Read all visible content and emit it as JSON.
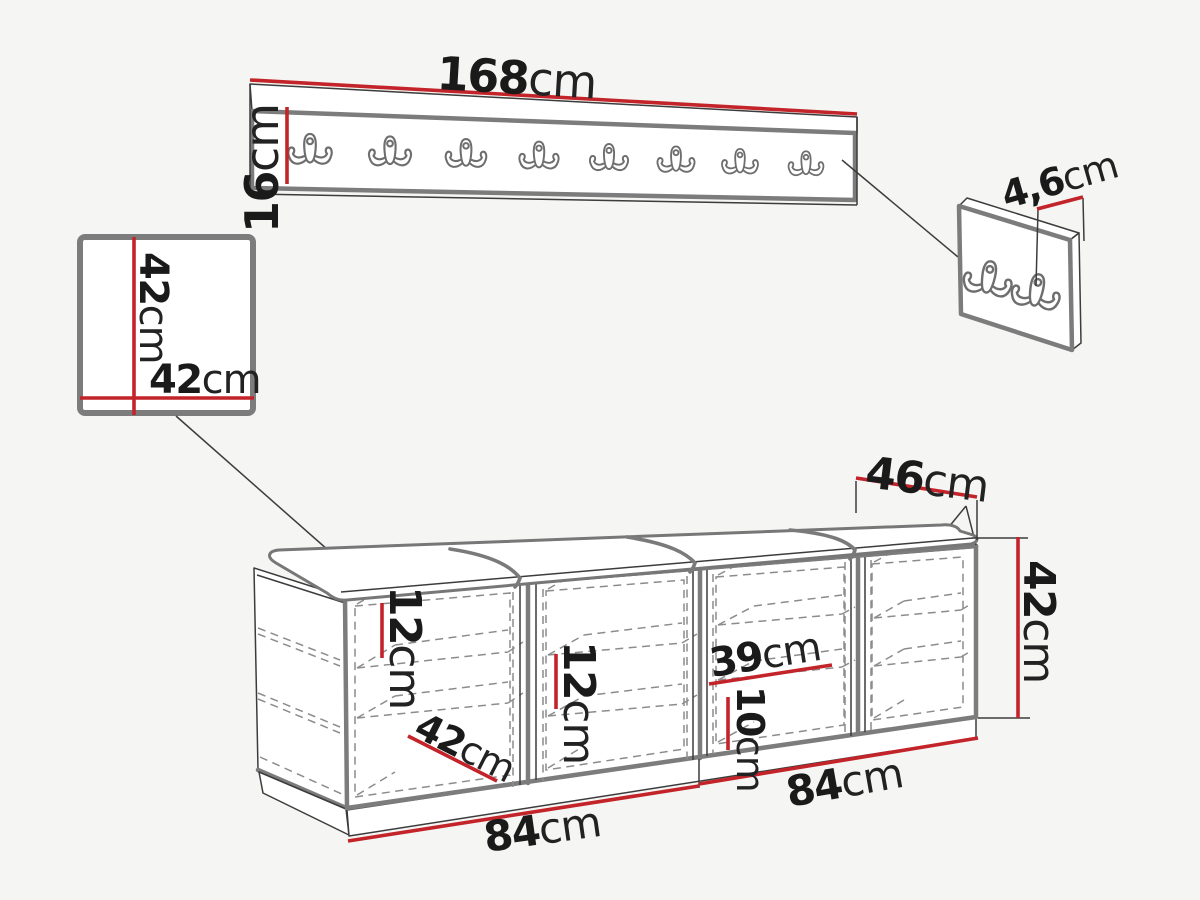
{
  "colors": {
    "background": "#f5f5f3",
    "dimension_red": "#c3242a",
    "frame_gray": "#7c7c7c",
    "line_dark": "#3c3c3c",
    "dash_gray": "#8c8c8c",
    "text_black": "#1a1a1a"
  },
  "coat_rack": {
    "hook_count": 8,
    "width": {
      "value": "168",
      "unit": "cm"
    },
    "height": {
      "value": "16",
      "unit": "cm"
    }
  },
  "hook_panel": {
    "hook_count": 2,
    "depth": {
      "value": "4,6",
      "unit": "cm"
    }
  },
  "mirror_panel": {
    "height": {
      "value": "42",
      "unit": "cm"
    },
    "width": {
      "value": "42",
      "unit": "cm"
    }
  },
  "bench": {
    "compartment_count": 4,
    "seat_cushion_count": 4,
    "depth": {
      "value": "46",
      "unit": "cm"
    },
    "height": {
      "value": "42",
      "unit": "cm"
    },
    "shelf_spacing_first": {
      "value": "12",
      "unit": "cm"
    },
    "shelf_spacing_second": {
      "value": "12",
      "unit": "cm"
    },
    "shelf_width": {
      "value": "39",
      "unit": "cm"
    },
    "bottom_clearance": {
      "value": "10",
      "unit": "cm"
    },
    "compartment_depth": {
      "value": "42",
      "unit": "cm"
    },
    "left_section_width": {
      "value": "84",
      "unit": "cm"
    },
    "right_section_width": {
      "value": "84",
      "unit": "cm"
    }
  }
}
